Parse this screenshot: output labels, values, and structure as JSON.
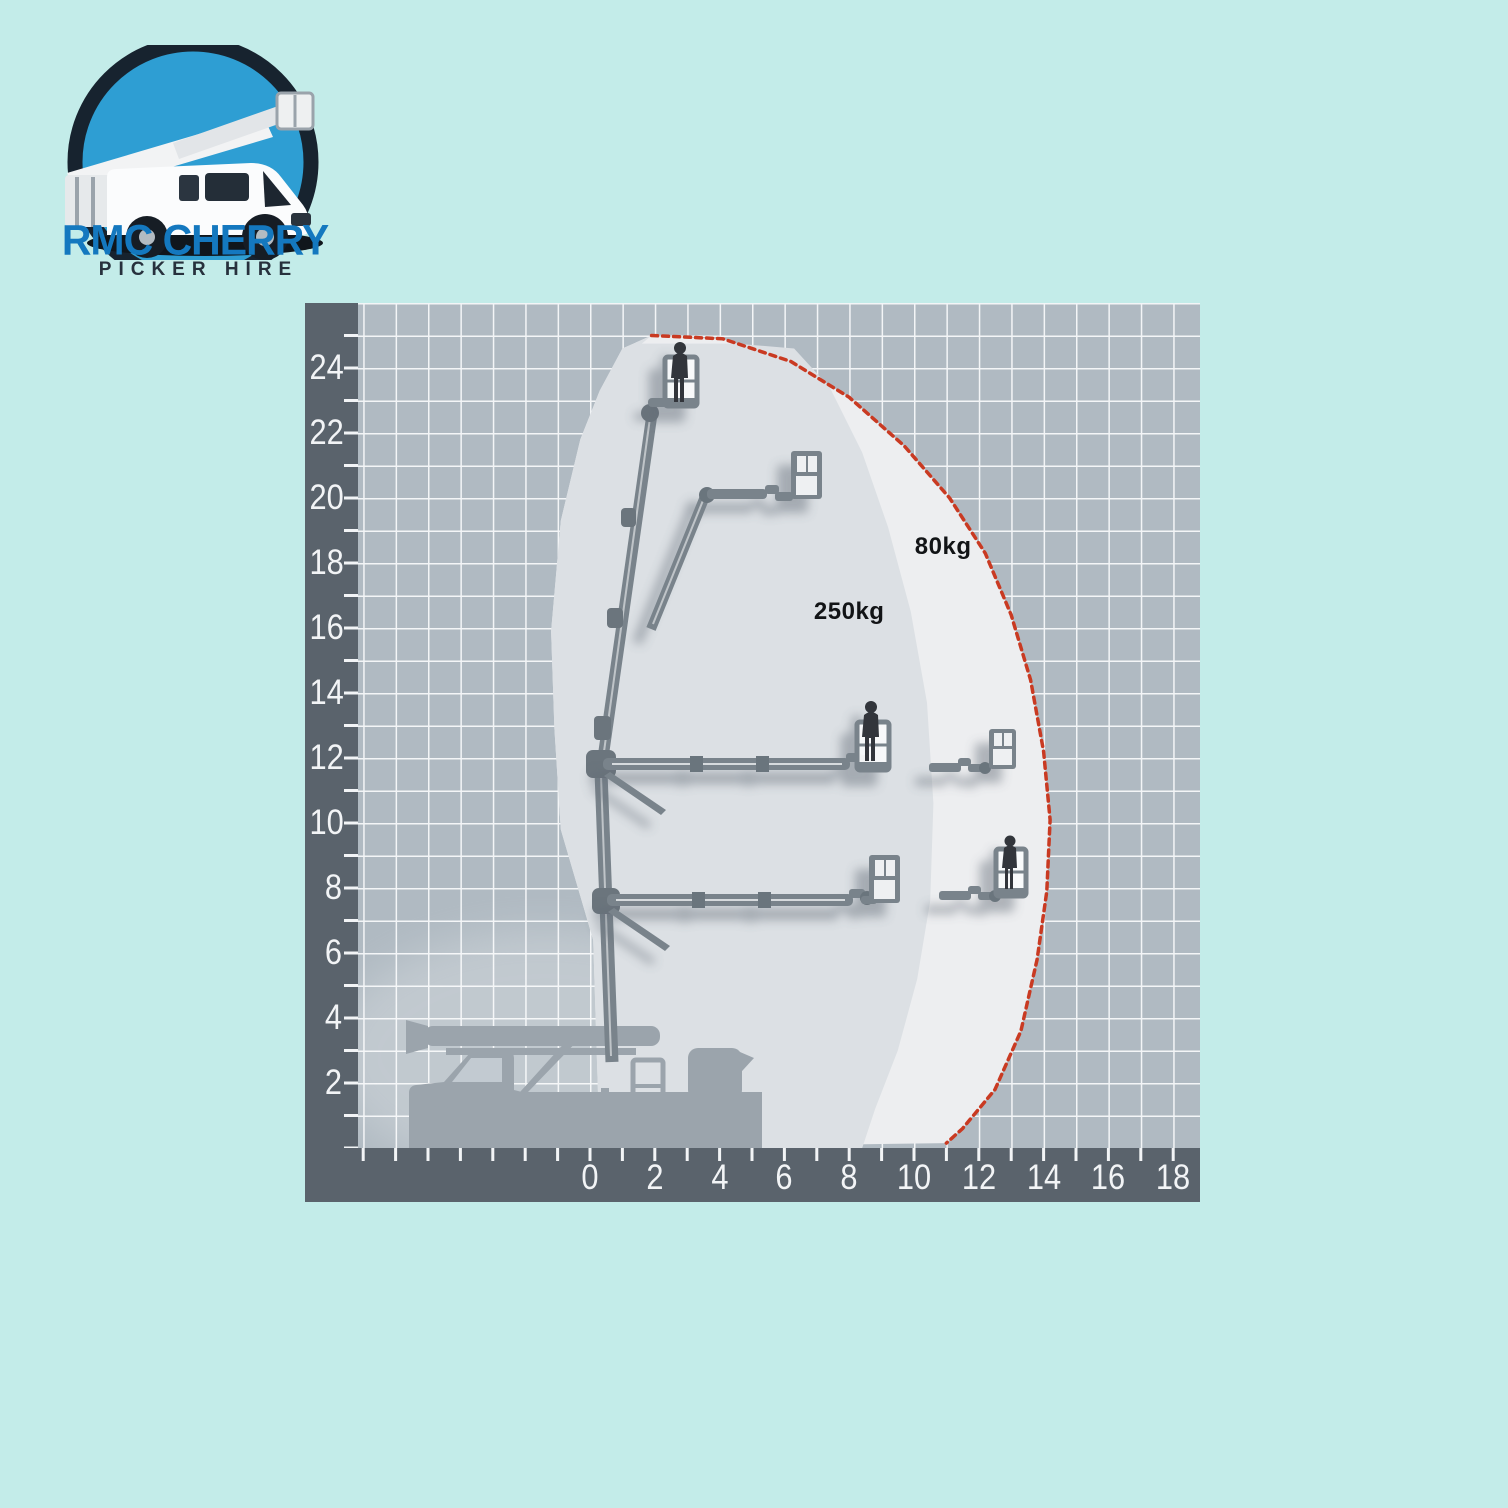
{
  "page": {
    "bg_color": "#c3ece9"
  },
  "logo": {
    "title": "RMC CHERRY",
    "subtitle": "PICKER HIRE",
    "title_color": "#1478bf",
    "subtitle_color": "#27313d",
    "icon": "cherry-picker-truck-logo",
    "circle_fill": "#2e9ed3",
    "circle_ring": "#17232f"
  },
  "chart_data": {
    "type": "area",
    "title": "Cherry picker working envelope (outreach vs height, metres)",
    "xlabel": "",
    "ylabel": "",
    "x_range": [
      -7,
      19
    ],
    "y_range": [
      0,
      26
    ],
    "grid": true,
    "legend": "none",
    "x_tick_values": [
      0,
      2,
      4,
      6,
      8,
      10,
      12,
      14,
      16,
      18
    ],
    "x_tick_labels": [
      "0",
      "2",
      "4",
      "6",
      "8",
      "10",
      "12",
      "14",
      "16",
      "18"
    ],
    "y_tick_values": [
      24,
      22,
      20,
      18,
      16,
      14,
      12,
      10,
      8,
      6,
      4,
      2
    ],
    "y_tick_labels": [
      "24",
      "22",
      "20",
      "18",
      "16",
      "14",
      "12",
      "10",
      "8",
      "6",
      "4",
      "2"
    ],
    "region_labels": [
      {
        "text": "80kg",
        "x": 10.9,
        "y": 18.5
      },
      {
        "text": "250kg",
        "x": 8.0,
        "y": 16.5
      }
    ],
    "series": [
      {
        "name": "80kg load limit",
        "style": "red-dotted-boundary",
        "color": "#c93a22",
        "points": [
          [
            1.9,
            25.0
          ],
          [
            4.1,
            24.9
          ],
          [
            6.2,
            24.2
          ],
          [
            8.0,
            23.1
          ],
          [
            9.7,
            21.6
          ],
          [
            11.1,
            20.0
          ],
          [
            12.2,
            18.3
          ],
          [
            13.0,
            16.4
          ],
          [
            13.6,
            14.4
          ],
          [
            14.0,
            12.2
          ],
          [
            14.2,
            10.1
          ],
          [
            14.1,
            7.9
          ],
          [
            13.8,
            5.8
          ],
          [
            13.3,
            3.6
          ],
          [
            12.5,
            1.8
          ],
          [
            11.5,
            0.6
          ],
          [
            11.0,
            0.15
          ]
        ]
      },
      {
        "name": "250kg load limit",
        "style": "region-edge",
        "color": "#dce0e4",
        "points": [
          [
            1.6,
            24.75
          ],
          [
            4.5,
            24.75
          ],
          [
            6.3,
            24.6
          ],
          [
            7.4,
            23.4
          ],
          [
            8.4,
            21.4
          ],
          [
            9.2,
            19.1
          ],
          [
            9.9,
            16.5
          ],
          [
            10.4,
            13.7
          ],
          [
            10.6,
            10.6
          ],
          [
            10.5,
            7.6
          ],
          [
            10.1,
            5.2
          ],
          [
            9.5,
            3.0
          ],
          [
            8.8,
            1.2
          ],
          [
            8.4,
            0.0
          ]
        ]
      },
      {
        "name": "rear boundary",
        "style": "region-edge",
        "color": "#edeef0",
        "points": [
          [
            0.3,
            0.0
          ],
          [
            0.1,
            6.4
          ],
          [
            -0.9,
            9.8
          ],
          [
            -1.1,
            12.9
          ],
          [
            -1.2,
            15.9
          ],
          [
            -0.9,
            19.3
          ],
          [
            -0.3,
            21.8
          ],
          [
            0.3,
            23.3
          ],
          [
            1.0,
            24.6
          ],
          [
            1.9,
            25.0
          ]
        ]
      }
    ],
    "platforms": [
      {
        "outreach_m": 2.8,
        "floor_height_m": 22.9,
        "occupied": true
      },
      {
        "outreach_m": 6.7,
        "floor_height_m": 20.0,
        "occupied": false
      },
      {
        "outreach_m": 8.5,
        "floor_height_m": 11.7,
        "occupied": true
      },
      {
        "outreach_m": 12.4,
        "floor_height_m": 11.7,
        "occupied": false
      },
      {
        "outreach_m": 8.9,
        "floor_height_m": 7.5,
        "occupied": false
      },
      {
        "outreach_m": 12.9,
        "floor_height_m": 7.8,
        "occupied": true
      }
    ],
    "colors": {
      "axis_band": "#5a636c",
      "grid_bg": "#b0bac2",
      "grid_line": "#f3f5f7",
      "envelope_outer": "#edeef0",
      "envelope_inner": "#dce0e4",
      "machine_gray": "#79838b",
      "truck_gray": "#9ba4ac",
      "red_line": "#c93a22",
      "tick_color": "#f2f4f6"
    }
  }
}
